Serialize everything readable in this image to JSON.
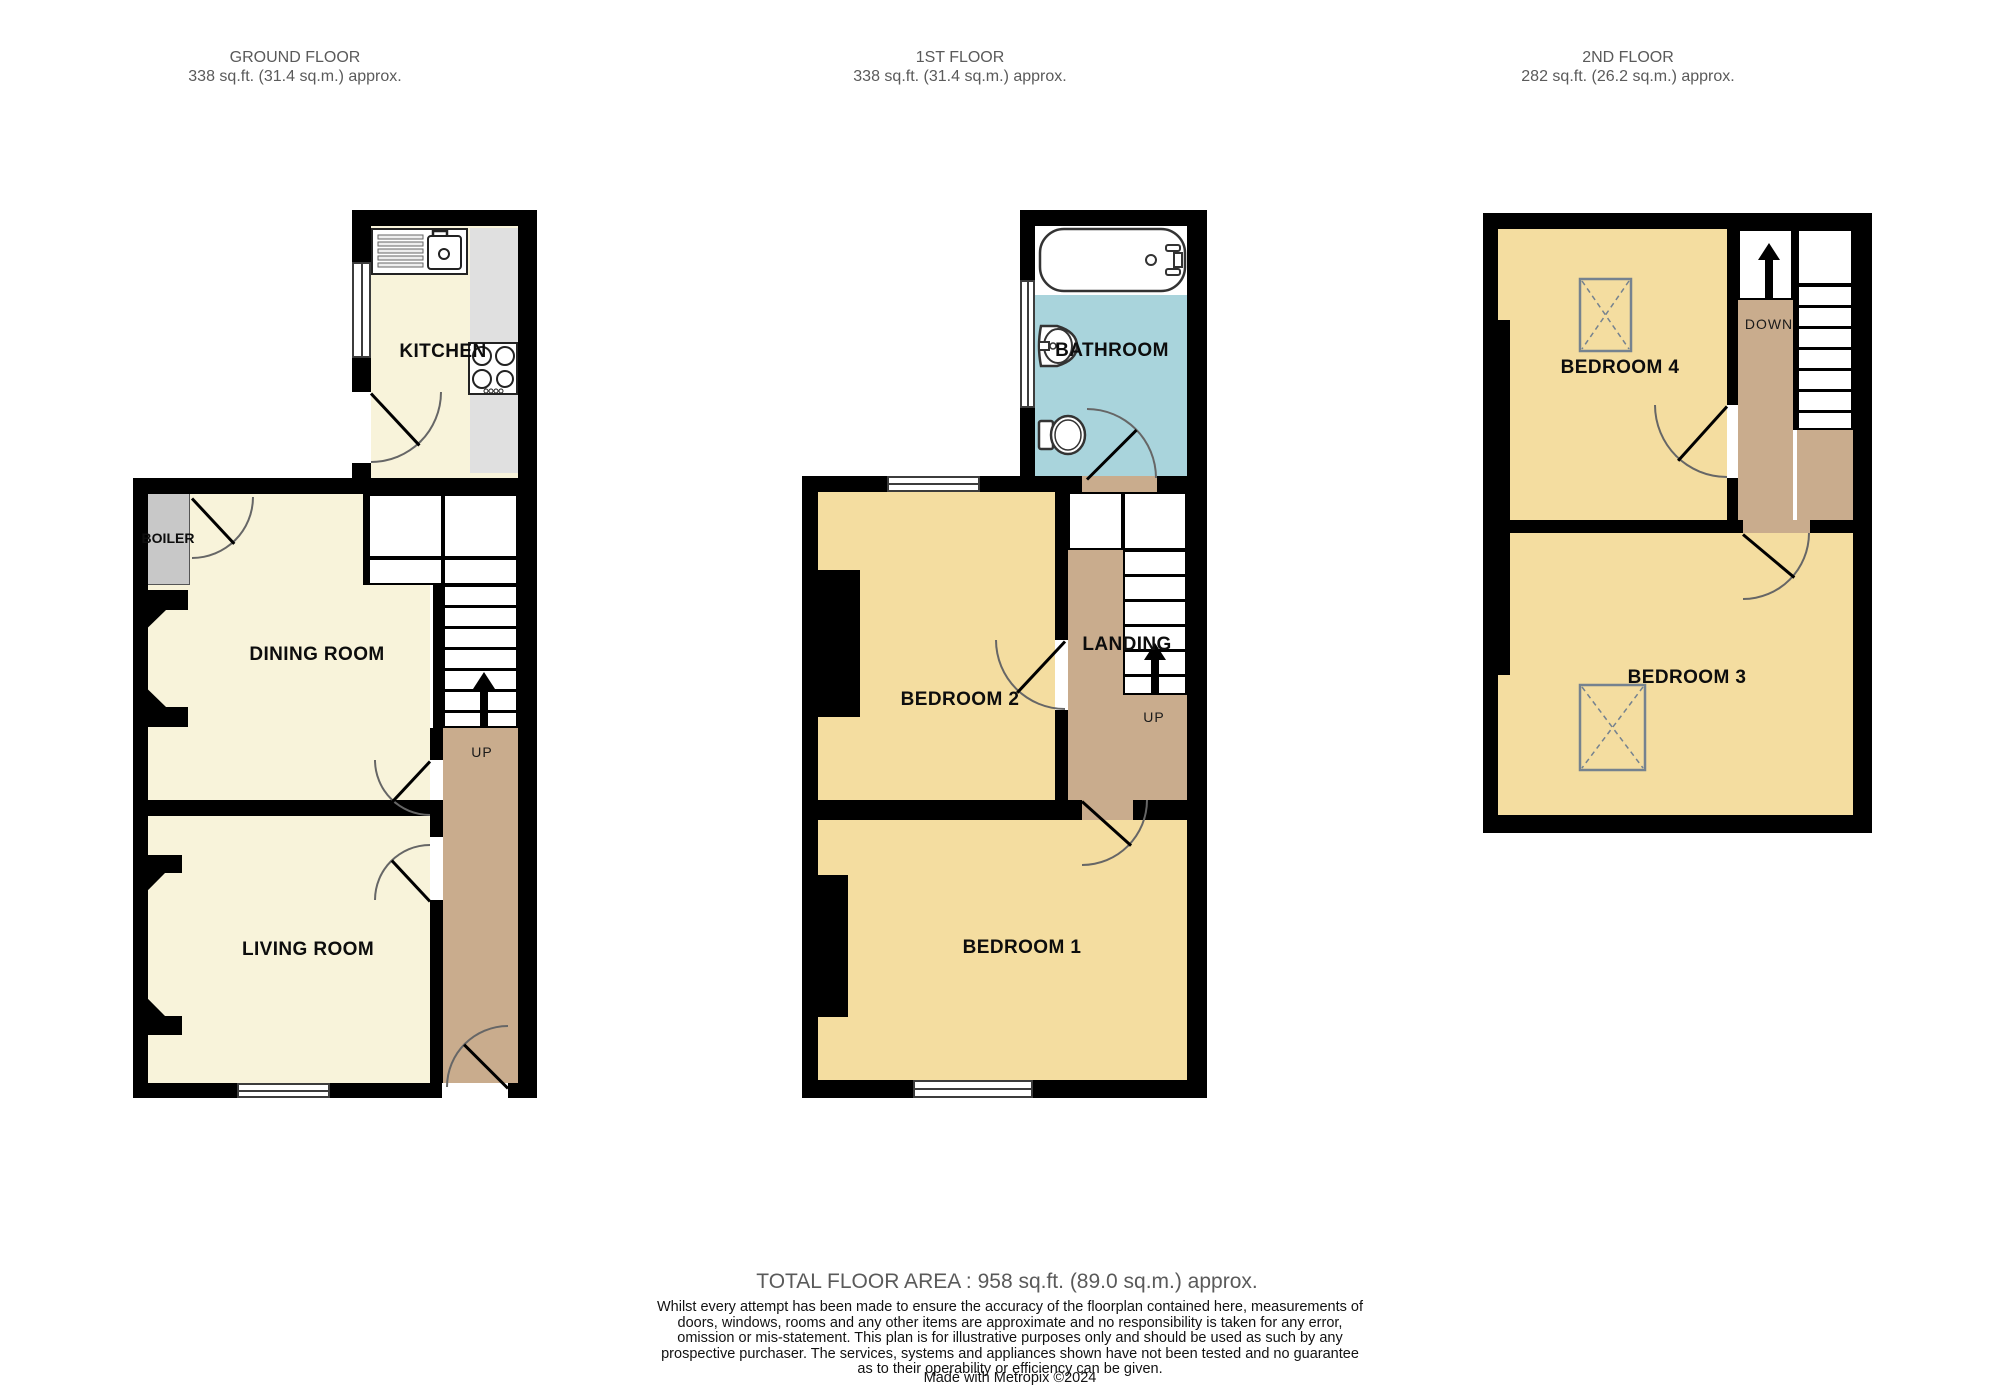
{
  "floors": [
    {
      "title": "GROUND FLOOR",
      "area": "338 sq.ft. (31.4 sq.m.) approx.",
      "rooms": {
        "kitchen": "KITCHEN",
        "dining": "DINING ROOM",
        "living": "LIVING ROOM",
        "boiler": "BOILER"
      },
      "stair_label": "UP"
    },
    {
      "title": "1ST FLOOR",
      "area": "338 sq.ft. (31.4 sq.m.) approx.",
      "rooms": {
        "bathroom": "BATHROOM",
        "bedroom2": "BEDROOM 2",
        "landing": "LANDING",
        "bedroom1": "BEDROOM 1"
      },
      "stair_label": "UP"
    },
    {
      "title": "2ND FLOOR",
      "area": "282 sq.ft. (26.2 sq.m.) approx.",
      "rooms": {
        "bedroom4": "BEDROOM 4",
        "bedroom3": "BEDROOM 3"
      },
      "stair_label": "DOWN"
    }
  ],
  "footer": {
    "total": "TOTAL FLOOR AREA : 958 sq.ft. (89.0 sq.m.) approx.",
    "disclaimer": "Whilst every attempt has been made to ensure the accuracy of the floorplan contained here, measurements of doors, windows, rooms and any other items are approximate and no responsibility is taken for any error, omission or mis-statement. This plan is for illustrative purposes only and should be used as such by any prospective purchaser. The services, systems and appliances shown have not been tested and no guarantee as to their operability or efficiency can be given.",
    "credit": "Made with Metropix ©2024"
  },
  "colors": {
    "wall": "#000000",
    "ground_room": "#f8f3da",
    "bedroom": "#f4dda0",
    "bathroom_floor": "#a9d4dc",
    "hall": "#c9ac8d",
    "boiler": "#c8c8c8",
    "counter": "#e0e0e0"
  }
}
